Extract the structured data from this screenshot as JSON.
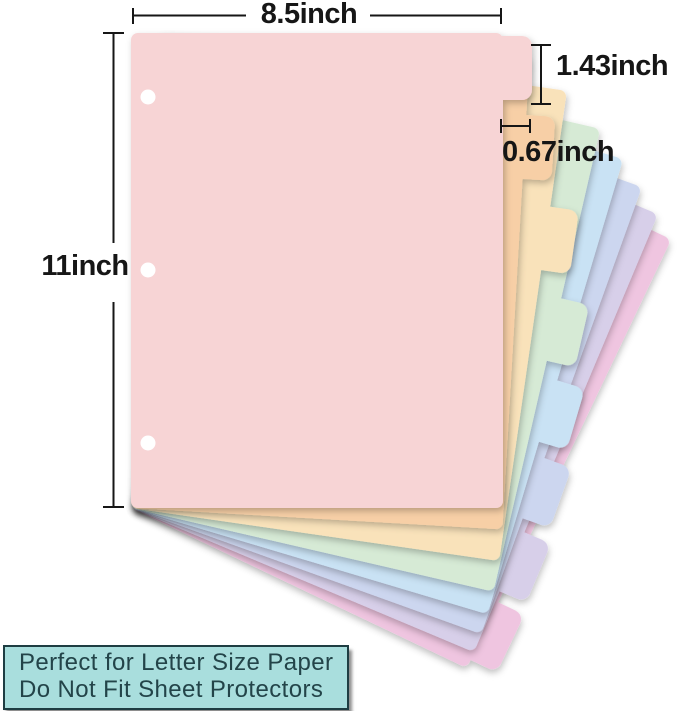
{
  "dimensions": {
    "sheet_width_label": "8.5inch",
    "sheet_height_label": "11inch",
    "tab_height_label": "1.43inch",
    "tab_depth_label": "0.67inch"
  },
  "note_box": {
    "line1": "Perfect for Letter Size Paper",
    "line2": "Do Not Fit Sheet Protectors",
    "background": "#a9dedd",
    "border": "#1e3d42",
    "text_color": "#234449"
  },
  "divider_sheets": [
    {
      "name": "pink",
      "color": "#f7d4d5",
      "tab_slot": 0,
      "angle": 0
    },
    {
      "name": "peach",
      "color": "#f7cfa6",
      "tab_slot": 1,
      "angle": 3.3
    },
    {
      "name": "cream",
      "color": "#f9e2ba",
      "tab_slot": 2,
      "angle": 8.2
    },
    {
      "name": "mint",
      "color": "#d6ead5",
      "tab_slot": 3,
      "angle": 13.0
    },
    {
      "name": "blue",
      "color": "#c9e2f4",
      "tab_slot": 4,
      "angle": 16.6
    },
    {
      "name": "periwinkle",
      "color": "#ccd6ef",
      "tab_slot": 5,
      "angle": 19.8
    },
    {
      "name": "lavender",
      "color": "#d7cfe9",
      "tab_slot": 6,
      "angle": 22.8
    },
    {
      "name": "magenta",
      "color": "#efc5e0",
      "tab_slot": 7,
      "angle": 25.5
    }
  ],
  "punch_holes": {
    "count": 3,
    "color": "#ffffff"
  },
  "line_color": "#161616"
}
